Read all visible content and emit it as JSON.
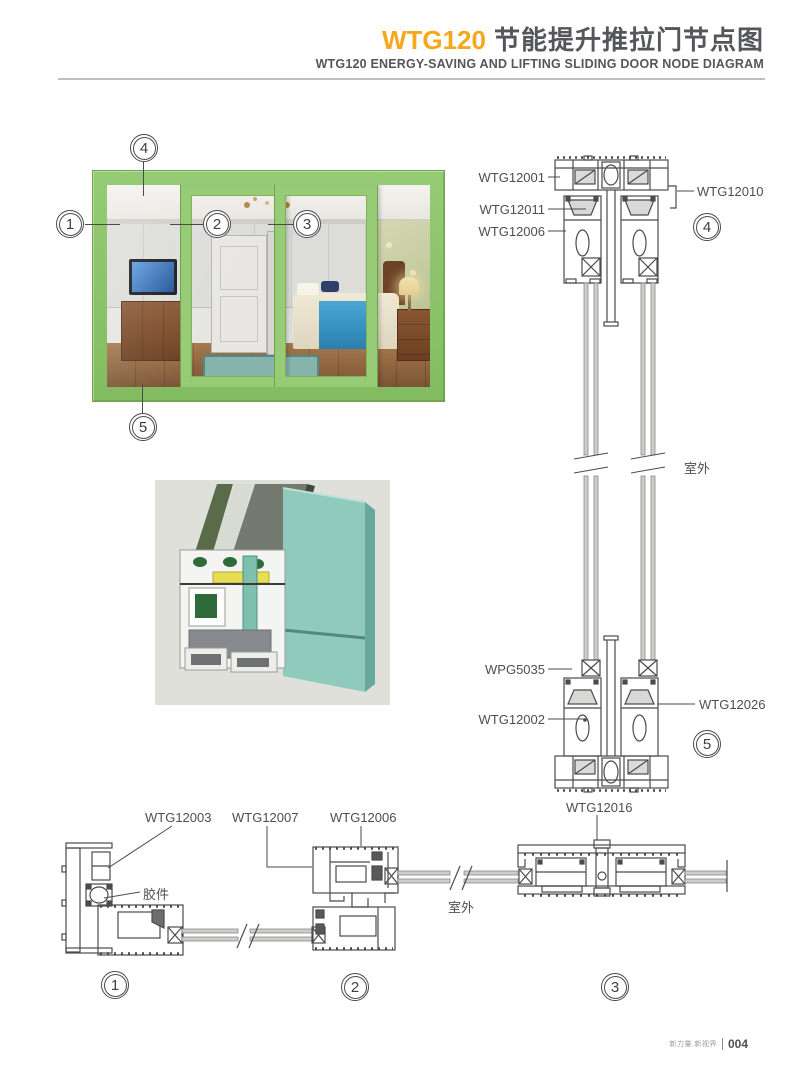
{
  "header": {
    "model": "WTG120",
    "title_cn": "节能提升推拉门节点图",
    "subtitle": "WTG120 ENERGY-SAVING AND LIFTING SLIDING DOOR NODE DIAGRAM",
    "accent_color": "#F5A81C",
    "text_color": "#55565A"
  },
  "callouts": {
    "n1": "1",
    "n2": "2",
    "n3": "3",
    "n4": "4",
    "n5": "5"
  },
  "vertical_section": {
    "labels": {
      "wtg12001": "WTG12001",
      "wtg12011": "WTG12011",
      "wtg12006": "WTG12006",
      "wtg12010": "WTG12010",
      "wpg5035": "WPG5035",
      "wtg12002": "WTG12002",
      "wtg12026": "WTG12026"
    },
    "outdoor": "室外"
  },
  "horizontal_details": {
    "labels": {
      "wtg12003": "WTG12003",
      "wtg12007": "WTG12007",
      "wtg12006": "WTG12006",
      "wtg12016": "WTG12016",
      "gasket": "胶件"
    },
    "outdoor": "室外"
  },
  "window_figure": {
    "frame_color": "#8CC56B"
  },
  "render_figure": {
    "panel_color": "#8FCABD"
  },
  "footer": {
    "slogan": "新力量.新视界",
    "page_number": "004"
  }
}
